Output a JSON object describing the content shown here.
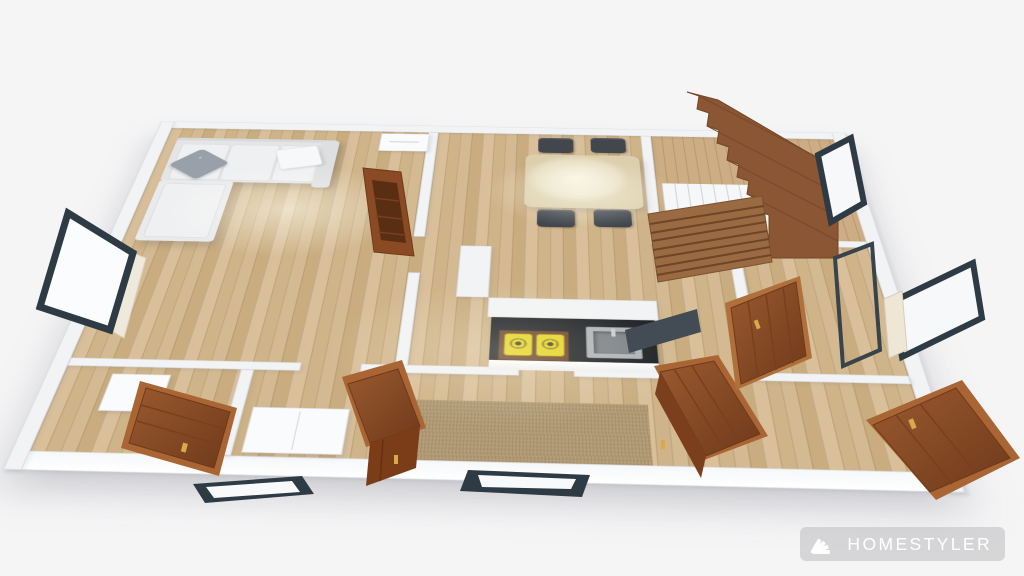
{
  "scene": {
    "description": "3D floor plan render viewed from above in perspective",
    "watermark": {
      "brand": "HOMESTYLER",
      "icon": "homestyler-fan-icon"
    },
    "colors": {
      "background": "#f5f5f6",
      "wall": "#f2f3f5",
      "floor_wood": "#d5bb93",
      "stair_wood": "#8a5634",
      "cabinet_wood": "#8f4e26",
      "cabinet_cornice": "#b0703b",
      "counter_black": "#1f2226",
      "burner_yellow": "#e5d31f",
      "window_frame": "#2e3b44",
      "sofa_fabric": "#e6e8ea",
      "pillow_gray": "#98a0a9",
      "chair_dark": "#42474e",
      "table_cream": "#ece3cc",
      "hall_runner": "#b19a74",
      "sink_steel": "#aeb3b7"
    },
    "objects": [
      {
        "id": "sectional-sofa",
        "label": "L-shaped sectional sofa with gray and white pillows"
      },
      {
        "id": "tv-sideboard",
        "label": "white sideboard"
      },
      {
        "id": "bookcase-living",
        "label": "tall wooden bookcase"
      },
      {
        "id": "dining-table",
        "label": "dining table with four dark chairs"
      },
      {
        "id": "staircase",
        "label": "wooden staircase with upper and lower flight"
      },
      {
        "id": "kitchen-counter",
        "label": "kitchen island with black countertop"
      },
      {
        "id": "gas-burners",
        "label": "two yellow gas burners"
      },
      {
        "id": "kitchen-sink",
        "label": "stainless steel sink"
      },
      {
        "id": "hallway-runner",
        "label": "brown hallway carpet runner"
      },
      {
        "id": "wardrobe-bedroom-left",
        "label": "wooden wardrobe bottom-left room"
      },
      {
        "id": "cabinet-hallway",
        "label": "wooden cabinet in hallway"
      },
      {
        "id": "cabinet-kitchen-side",
        "label": "wooden cabinet beside kitchen"
      },
      {
        "id": "wardrobe-room-right",
        "label": "wooden wardrobe right room"
      },
      {
        "id": "wardrobe-bottom-right",
        "label": "wooden wardrobe bottom-right room"
      },
      {
        "id": "storage-cabinet-white",
        "label": "white two-door cabinet"
      },
      {
        "id": "nightstand",
        "label": "white nightstand"
      },
      {
        "id": "window-left",
        "label": "dark framed window left wall"
      },
      {
        "id": "window-right-upper",
        "label": "dark framed window right wall upper"
      },
      {
        "id": "window-right-lower",
        "label": "dark framed window right wall lower"
      },
      {
        "id": "window-bottom-left",
        "label": "dark framed window bottom wall left"
      },
      {
        "id": "window-bottom-center",
        "label": "dark framed window bottom wall center"
      },
      {
        "id": "glass-partition-right",
        "label": "dark glass partition with door panel"
      }
    ]
  }
}
